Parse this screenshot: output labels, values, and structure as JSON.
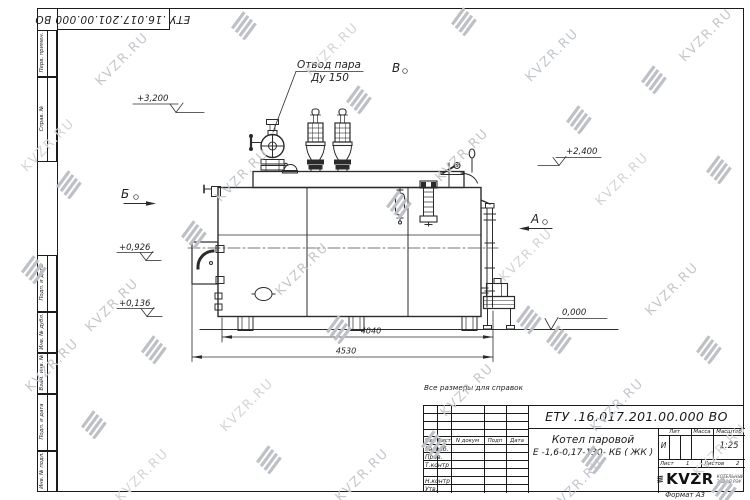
{
  "watermark": {
    "text": "KVZR.RU"
  },
  "corner_stamp": {
    "doc_number": "ЕТУ .16.017.201.00.000  ВО"
  },
  "margin": {
    "perv": "Перв. примен.",
    "sprav": "Справ. №",
    "podp1": "Подп. и дата",
    "dubl": "Инв. № дубл.",
    "vzam": "Взам. инв. №",
    "podp2": "Подп. и дата",
    "podl": "Инв. № подл."
  },
  "drawing": {
    "callout1": "Отвод пара",
    "callout2": "Ду 150",
    "elev_3200": "+3,200",
    "elev_2400": "+2,400",
    "elev_0926": "+0,926",
    "elev_0136": "+0,136",
    "elev_0": "0,000",
    "view_b": "Б",
    "view_v": "В",
    "view_a": "А",
    "dim1": "4040",
    "dim2": "4530"
  },
  "note": "Все размеры для справок",
  "title_block": {
    "doc_number": "ЕТУ .16.017.201.00.000  ВО",
    "name1": "Котел паровой",
    "name2": "Е -1,6-0,17-130- КБ ( ЖК )",
    "col_izm": "Изм",
    "col_list": "Лист",
    "col_doc": "N докум",
    "col_podp": "Подп",
    "col_data": "Дата",
    "row_razrab": "Разраб.",
    "row_prov": "Пров.",
    "row_tkontr": "Т.контр",
    "row_nkontr": "Н.контр",
    "row_utv": "Утв.",
    "lit_label": "Лит",
    "lit_value": "И",
    "massa_label": "Масса",
    "masshtab_label": "Масштаб",
    "masshtab_value": "1:25",
    "list_label": "Лист",
    "list_value": "1",
    "listov_label": "Листов",
    "listov_value": "2",
    "logo_text": "KVZR",
    "logo_sub1": "КОТЕЛЬНЫЙ",
    "logo_sub2": "ЗАВОД РЭУ",
    "format": "Формат А3"
  }
}
